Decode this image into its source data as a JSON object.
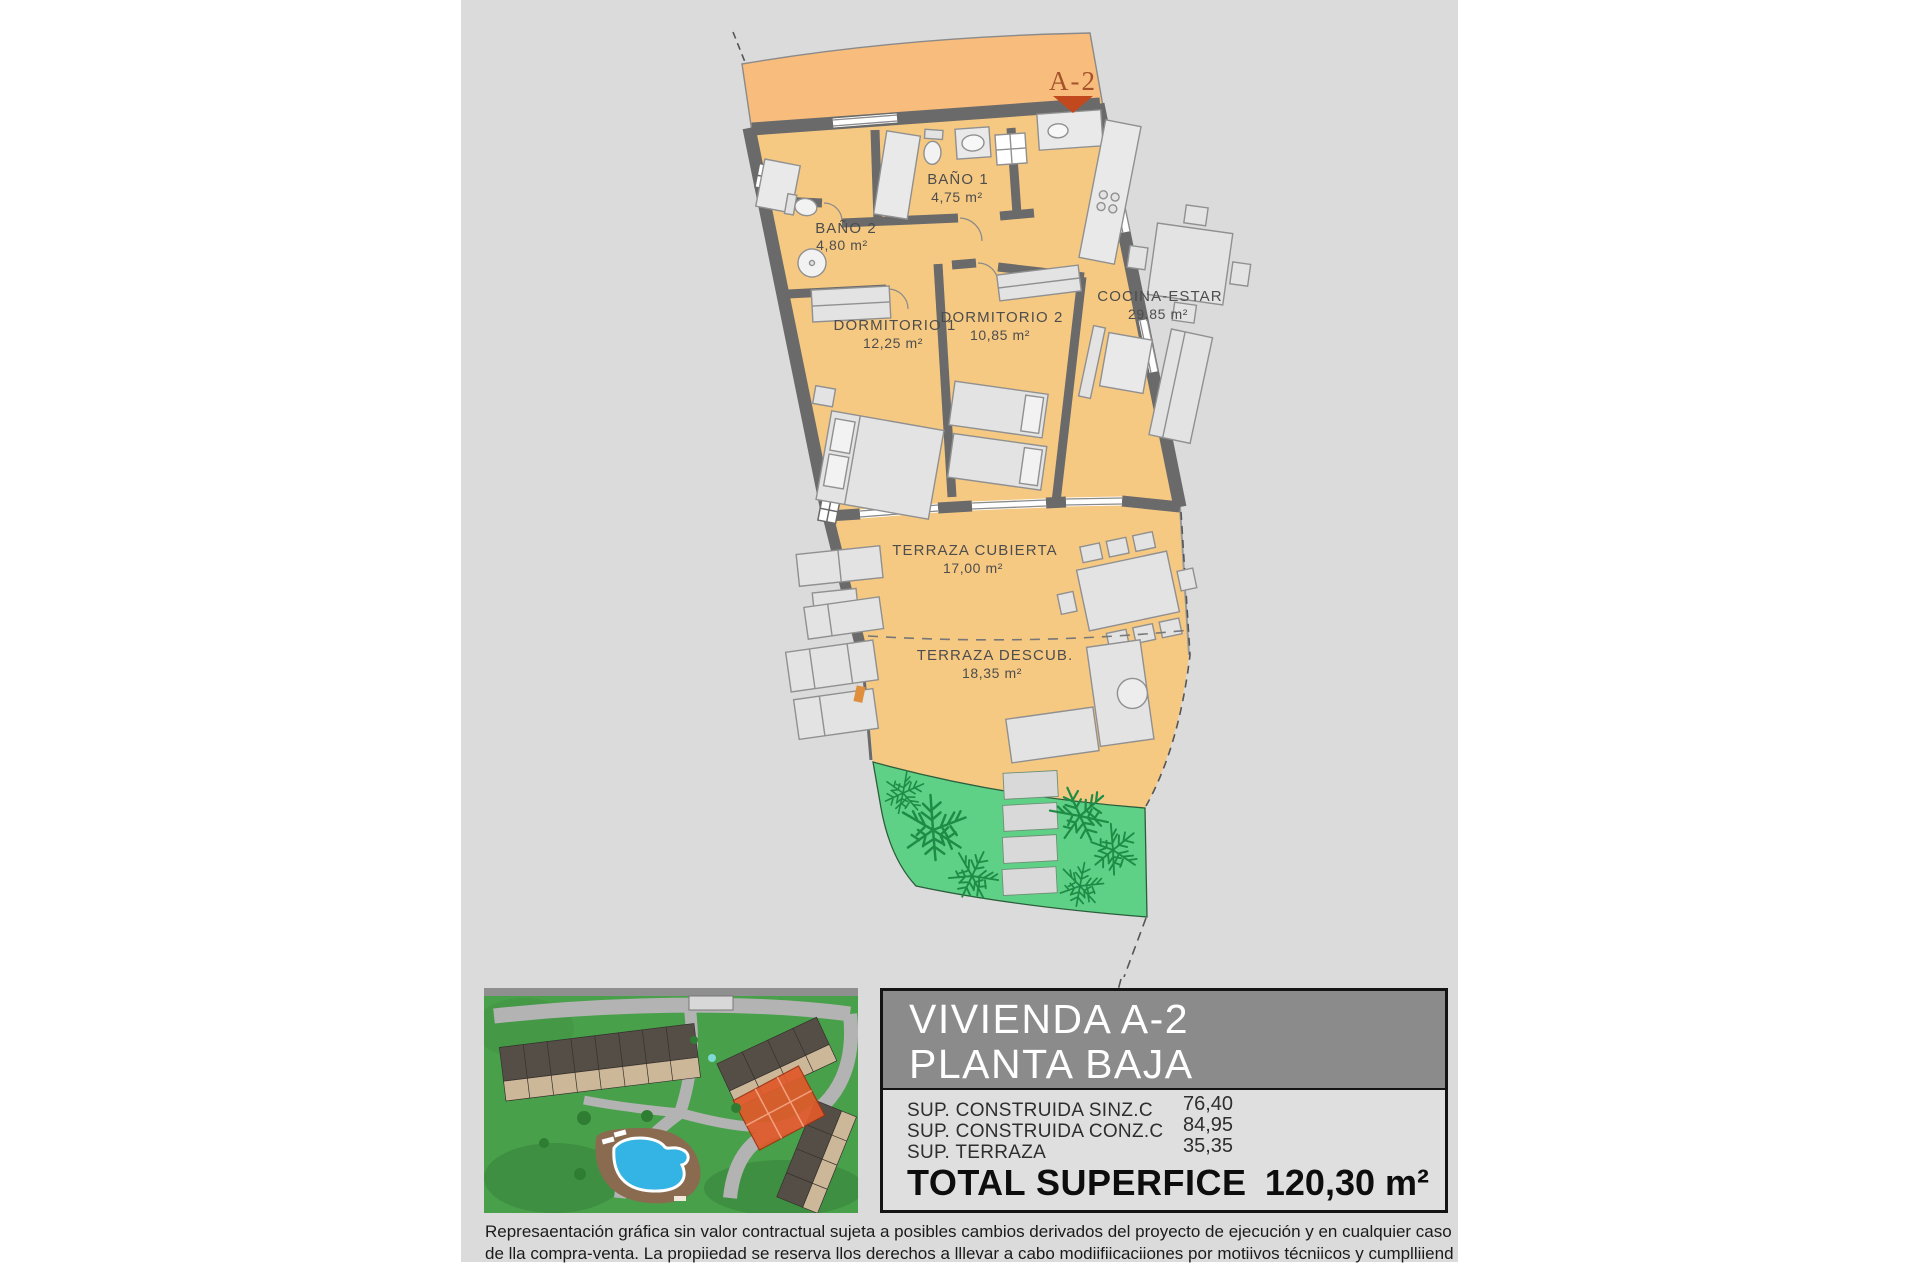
{
  "plan": {
    "unit_marker": "A-2",
    "rooms": [
      {
        "name": "BAÑO 1",
        "area": "4,75 m²"
      },
      {
        "name": "BAÑO 2",
        "area": "4,80 m²"
      },
      {
        "name": "DORMITORIO 1",
        "area": "12,25 m²"
      },
      {
        "name": "DORMITORIO 2",
        "area": "10,85 m²"
      },
      {
        "name": "COCINA-ESTAR",
        "area": "29,85 m²"
      },
      {
        "name": "TERRAZA CUBIERTA",
        "area": "17,00 m²"
      },
      {
        "name": "TERRAZA DESCUB.",
        "area": "18,35 m²"
      }
    ]
  },
  "title_block": {
    "title_line1": "VIVIENDA A-2",
    "title_line2": "PLANTA BAJA",
    "rows": [
      {
        "label": "SUP. CONSTRUIDA SINZ.C",
        "value": "76,40"
      },
      {
        "label": "SUP. CONSTRUIDA CONZ.C",
        "value": "84,95"
      },
      {
        "label": "SUP. TERRAZA",
        "value": "35,35"
      }
    ],
    "total_label": "TOTAL SUPERFICE",
    "total_value": "120,30 m²"
  },
  "disclaimer": {
    "line1": "Represaentación gráfica sin valor contractual sujeta a posibles cambios derivados del proyecto de ejecución y en cualquier caso será sustituido por el definitivo en",
    "line2": "de lla compra-venta. La propiiedad se reserva llos derechos a lllevar a cabo modiifiicaciiones por motiivos técniicos y cumplliiendo lla normatiiva viigente."
  },
  "colors": {
    "panel_bg": "#DBDBDB",
    "floor": "#F6C983",
    "terrace_band": "#F8BC7C",
    "wall": "#6A6A6A",
    "garden": "#5FD186",
    "fern": "#1E8C46",
    "marker_text": "#A5532B",
    "marker_arrow": "#C2491D",
    "header_bg": "#8B8B8B",
    "highlight_unit": "#E05A2B",
    "pool": "#33B4E4"
  }
}
